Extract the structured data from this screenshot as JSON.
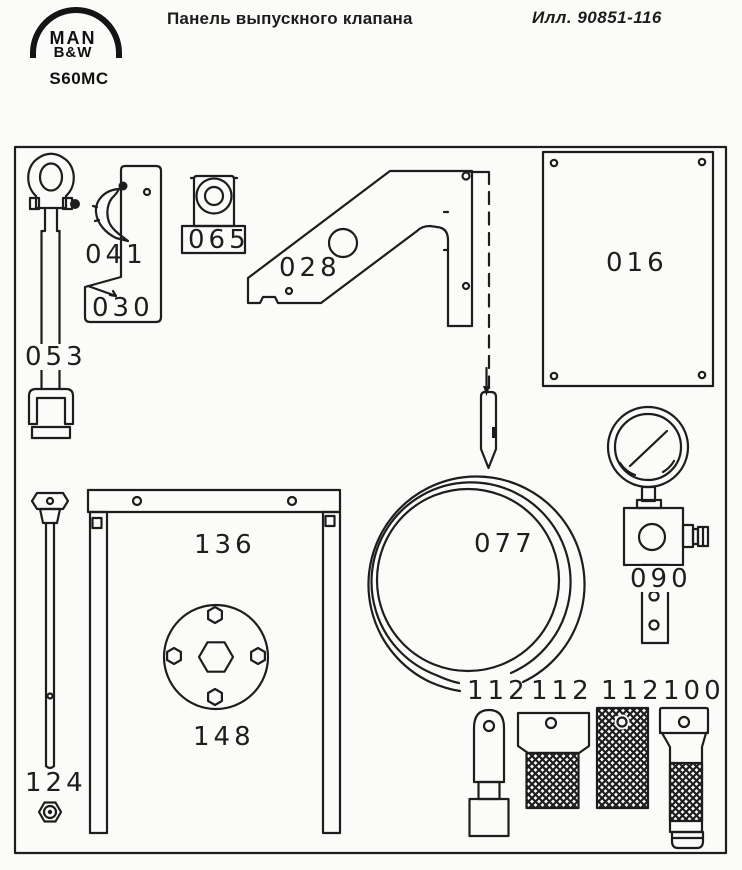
{
  "header": {
    "logo_line1": "MAN",
    "logo_line2": "B&W",
    "engine_model": "S60MC",
    "title": "Панель выпускного клапана",
    "illustration_ref": "Илл.  90851-116"
  },
  "parts": {
    "shackle_rod": "053",
    "hook": "041",
    "bracket": "030",
    "lifting_eye": "065",
    "support_bracket": "028",
    "plate": "016",
    "sealing_ring": "077",
    "pressure_gauge": "090",
    "frame": "136",
    "flange_disc": "148",
    "long_rod": "124",
    "punch": "112",
    "grinding_stone_small": "112",
    "grinding_stone_large": "112",
    "handle_tool": "100"
  },
  "colors": {
    "ink": "#1d1d1d",
    "paper": "#fbfbf9"
  }
}
